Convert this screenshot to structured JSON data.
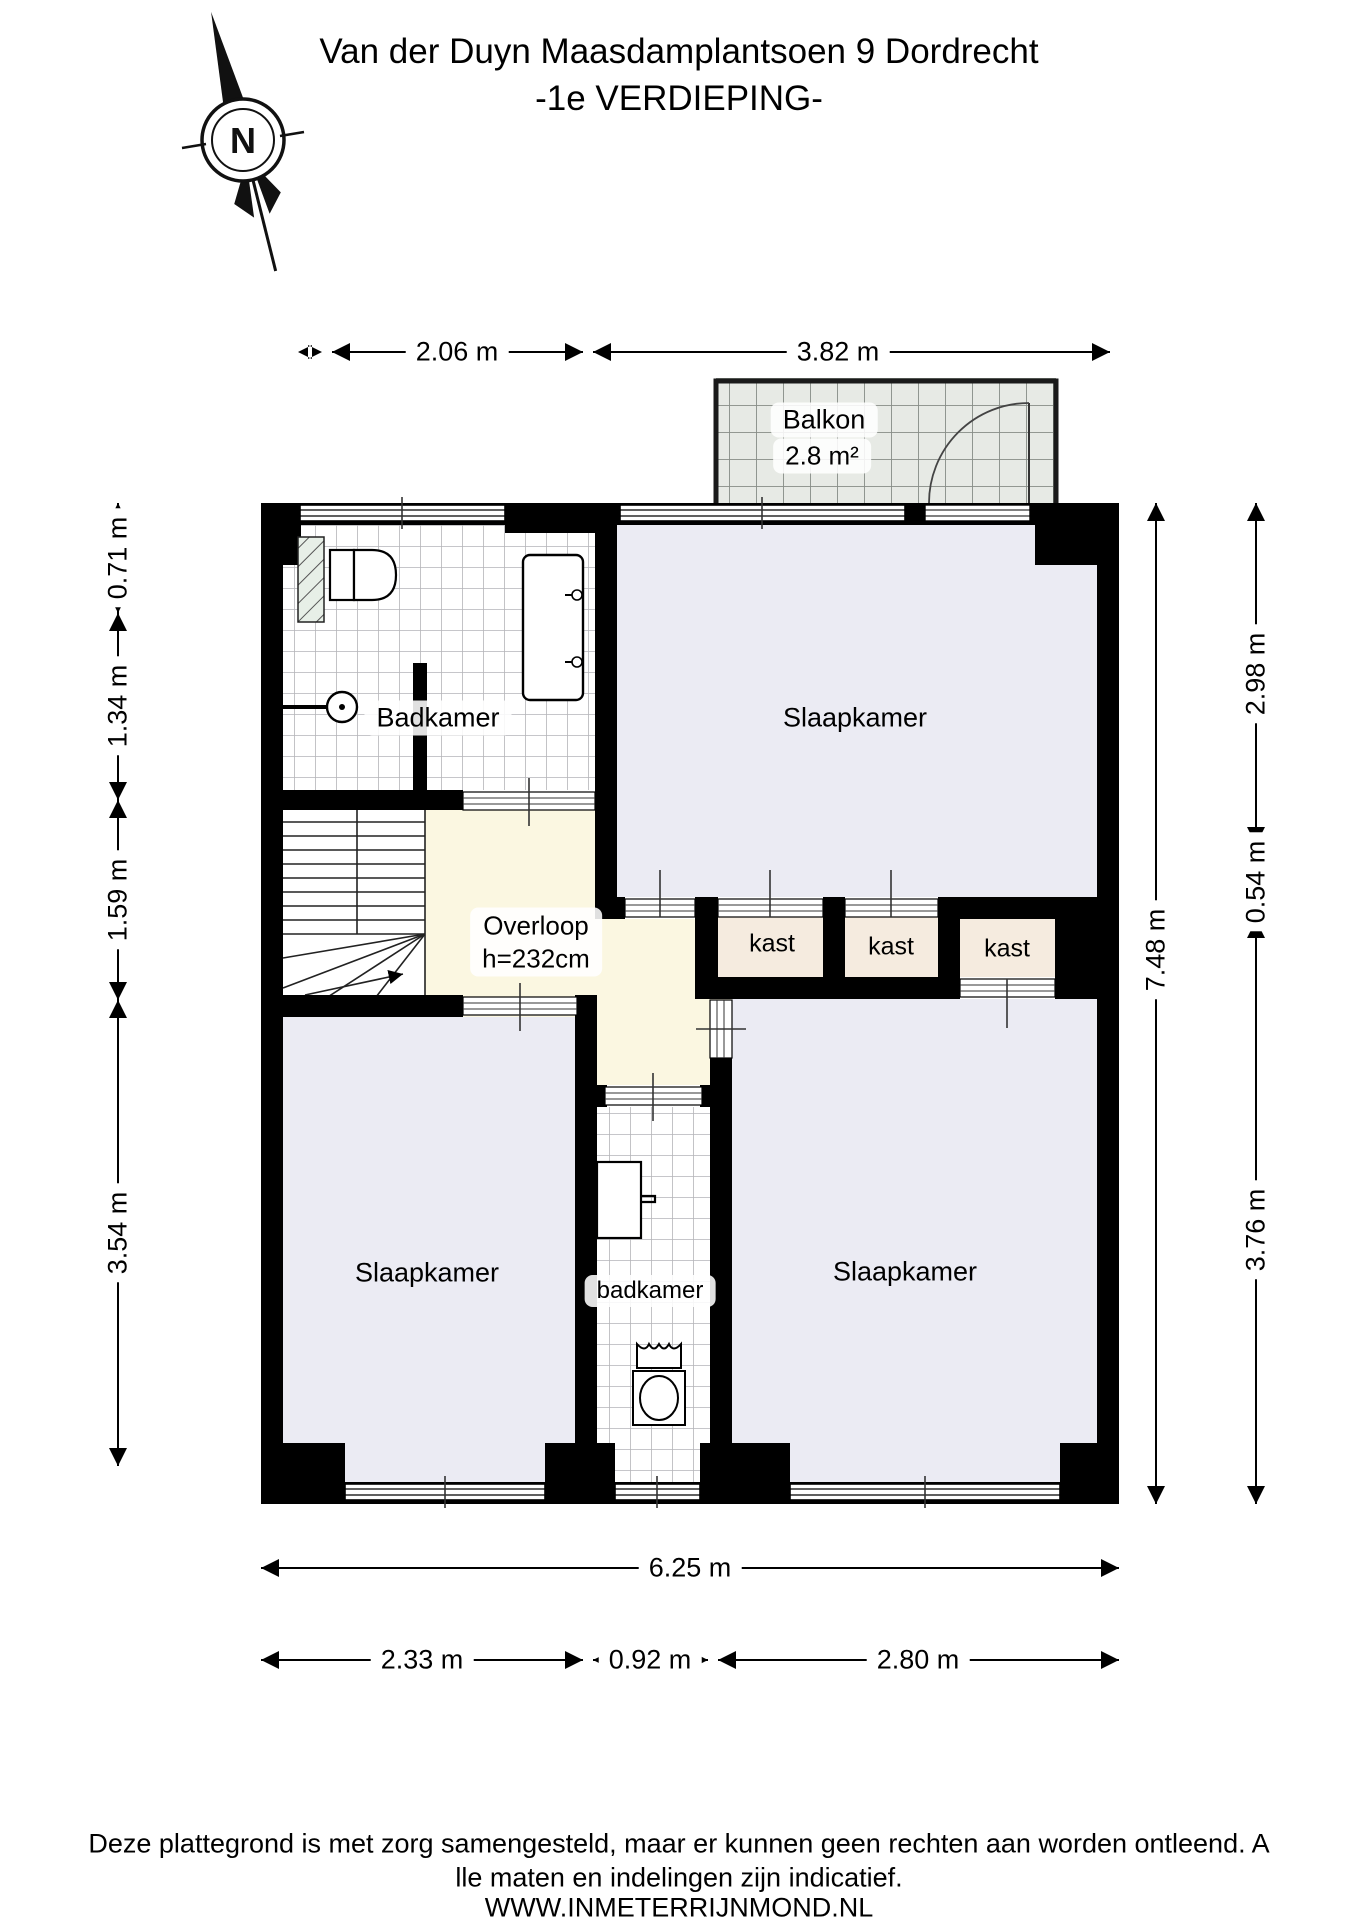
{
  "title": {
    "line1": "Van der Duyn Maasdamplantsoen 9 Dordrecht",
    "line2": "-1e VERDIEPING-"
  },
  "compass": {
    "label": "N"
  },
  "rooms": {
    "balkon": "Balkon",
    "balkon_area": "2.8 m²",
    "badkamer_top": "Badkamer",
    "slaapkamer_top": "Slaapkamer",
    "overloop_line1": "Overloop",
    "overloop_line2": "h=232cm",
    "kast1": "kast",
    "kast2": "kast",
    "kast3": "kast",
    "slaapkamer_left": "Slaapkamer",
    "slaapkamer_right": "Slaapkamer",
    "badkamer_bottom": "badkamer"
  },
  "dimensions": {
    "top": [
      "2.06 m",
      "3.82 m"
    ],
    "left": [
      "0.71 m",
      "1.34 m",
      "1.59 m",
      "3.54 m"
    ],
    "right": [
      "2.98 m",
      "0.54 m",
      "3.76 m"
    ],
    "right_total": "7.48 m",
    "bottom_total": "6.25 m",
    "bottom": [
      "2.33 m",
      "0.92 m",
      "2.80 m"
    ]
  },
  "footer": {
    "line1": "Deze plattegrond is met zorg samengesteld, maar er kunnen geen rechten aan worden ontleend. A",
    "line2": "lle maten en indelingen zijn indicatief.",
    "line3": "WWW.INMETERRIJNMOND.NL"
  },
  "colors": {
    "wall": "#000000",
    "bedroom_floor": "#ebebf3",
    "landing_floor": "#fbf7e1",
    "closet_floor": "#f5ebdf",
    "balcony_tile": "#e7eae5",
    "tile_line": "#b4b4b8"
  }
}
